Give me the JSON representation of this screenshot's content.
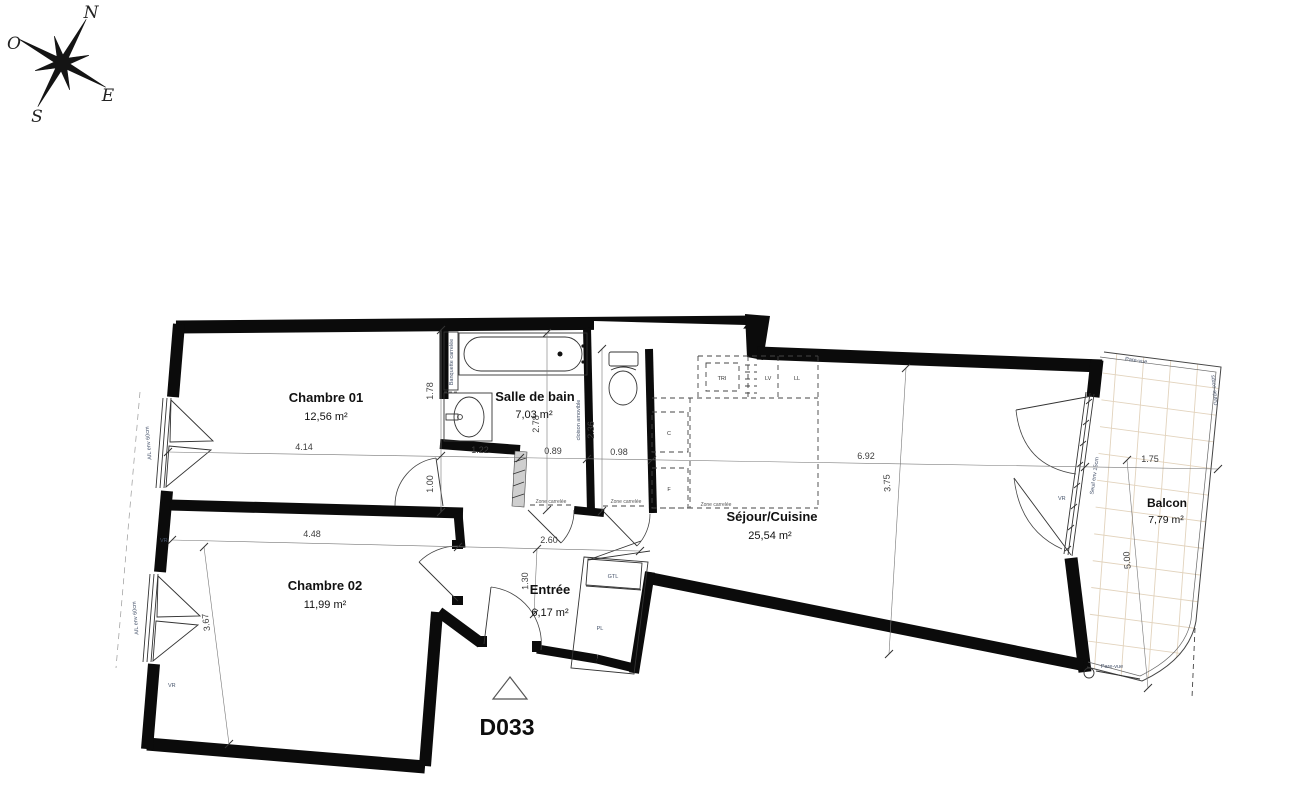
{
  "compass": {
    "n": "N",
    "e": "E",
    "s": "S",
    "o": "O"
  },
  "unit": {
    "label": "D033"
  },
  "rooms": {
    "chambre01": {
      "name": "Chambre 01",
      "area": "12,56 m²"
    },
    "salle_de_bain": {
      "name": "Salle de bain",
      "area": "7,03 m²"
    },
    "chambre02": {
      "name": "Chambre 02",
      "area": "11,99 m²"
    },
    "entree": {
      "name": "Entrée",
      "area": "6,17 m²"
    },
    "sejour": {
      "name": "Séjour/Cuisine",
      "area": "25,54 m²"
    },
    "balcon": {
      "name": "Balcon",
      "area": "7,79 m²"
    }
  },
  "dims": {
    "d414": "4.14",
    "d178": "1.78",
    "d100": "1.00",
    "d122": "1.22",
    "d089": "0.89",
    "d098": "0.98",
    "d278": "2.78",
    "d236": "2.36",
    "d692": "6.92",
    "d375": "3.75",
    "d448": "4.48",
    "d260": "2.60",
    "d130": "1.30",
    "d367": "3.67",
    "d175": "1.75",
    "d500": "5.00"
  },
  "appliances": {
    "tri": "TRI",
    "lv": "LV",
    "ll": "LL",
    "c": "C",
    "f": "F"
  },
  "annotations": {
    "banquette": "Banquette carrelée",
    "cloison": "cloison amovible",
    "zone_carrelee": "Zone carrelée",
    "allege": "AIL env 60cm",
    "vr": "VR",
    "seuil": "Seuil env 15cm",
    "pare_vue": "Pare-vue",
    "garde_corps": "Garde-corps",
    "gtl": "GTL",
    "pl": "PL"
  }
}
